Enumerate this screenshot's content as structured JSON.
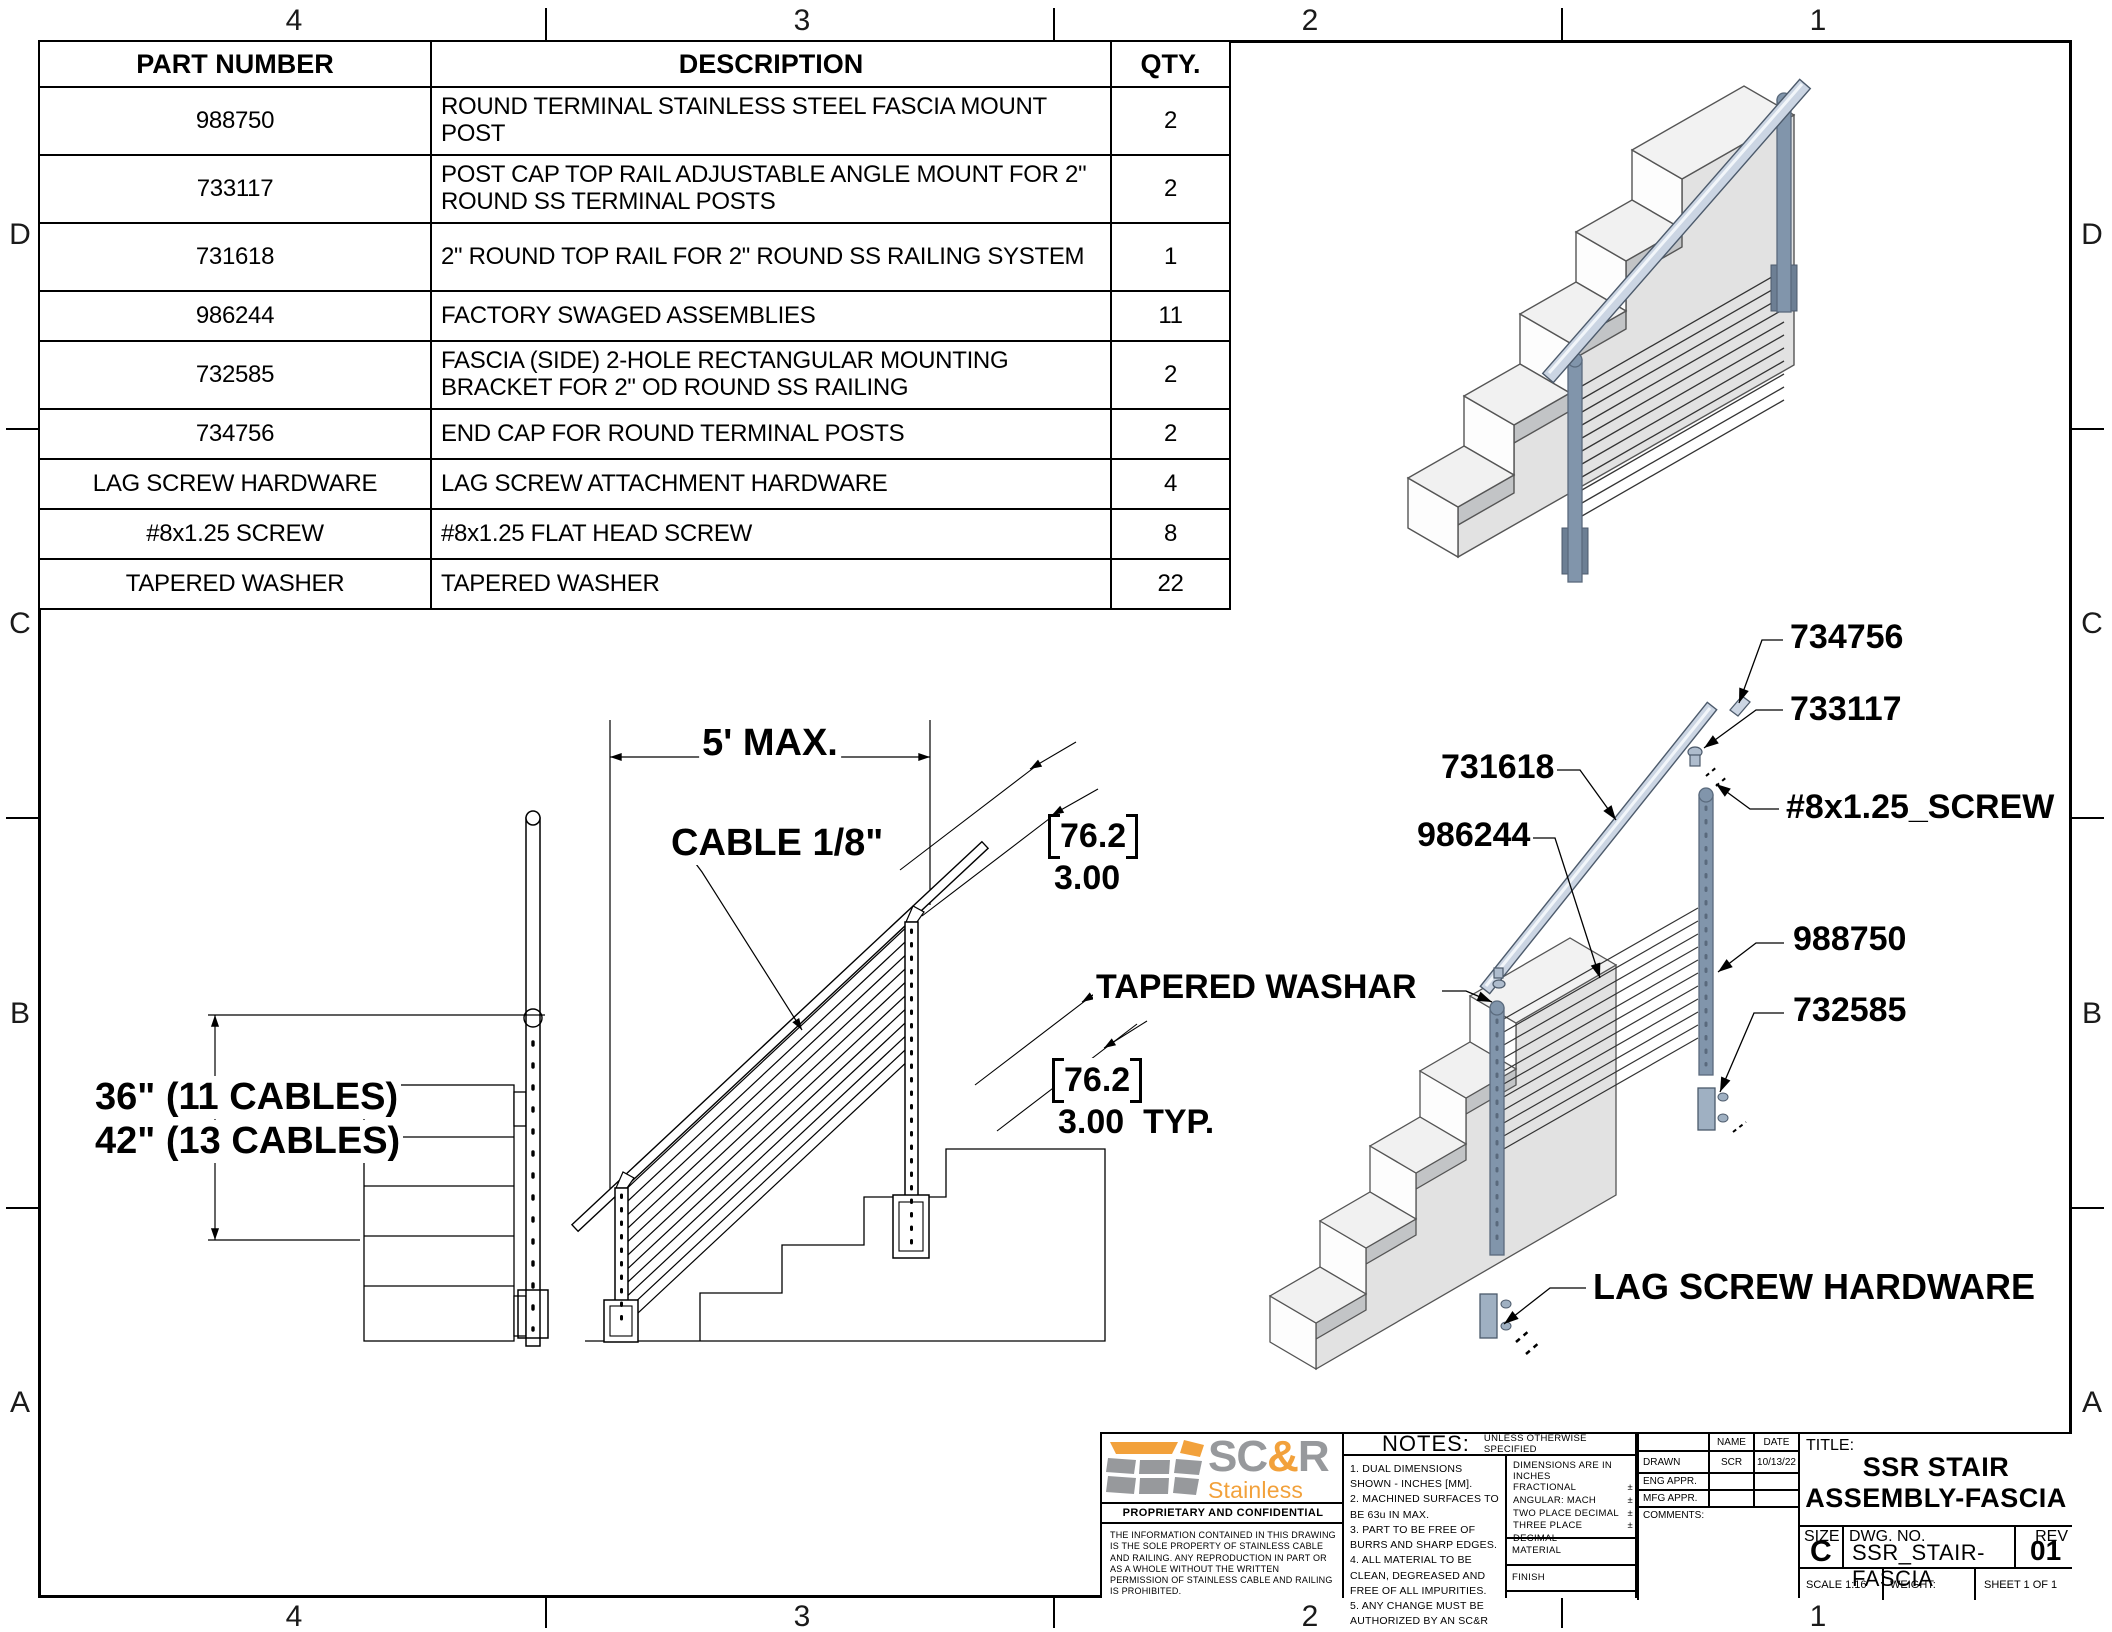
{
  "frame": {
    "top_numbers": [
      "4",
      "3",
      "2",
      "1"
    ],
    "bottom_numbers": [
      "4",
      "3",
      "2",
      "1"
    ],
    "left_letters": [
      "D",
      "C",
      "B",
      "A"
    ],
    "right_letters": [
      "D",
      "C",
      "B",
      "A"
    ]
  },
  "parts_table": {
    "headers": [
      "PART NUMBER",
      "DESCRIPTION",
      "QTY."
    ],
    "rows": [
      {
        "part": "988750",
        "desc": "ROUND TERMINAL STAINLESS STEEL FASCIA MOUNT POST",
        "qty": "2"
      },
      {
        "part": "733117",
        "desc": "POST CAP TOP RAIL ADJUSTABLE ANGLE MOUNT FOR 2\" ROUND SS TERMINAL POSTS",
        "qty": "2"
      },
      {
        "part": "731618",
        "desc": "2\" ROUND TOP RAIL FOR 2\" ROUND SS RAILING SYSTEM",
        "qty": "1"
      },
      {
        "part": "986244",
        "desc": "FACTORY SWAGED ASSEMBLIES",
        "qty": "11"
      },
      {
        "part": "732585",
        "desc": "FASCIA (SIDE) 2-HOLE RECTANGULAR MOUNTING BRACKET FOR 2\" OD ROUND SS RAILING",
        "qty": "2"
      },
      {
        "part": "734756",
        "desc": "END CAP FOR ROUND TERMINAL POSTS",
        "qty": "2"
      },
      {
        "part": "LAG SCREW HARDWARE",
        "desc": "LAG SCREW ATTACHMENT HARDWARE",
        "qty": "4"
      },
      {
        "part": "#8x1.25 SCREW",
        "desc": "#8x1.25 FLAT HEAD SCREW",
        "qty": "8"
      },
      {
        "part": "TAPERED WASHER",
        "desc": "TAPERED WASHER",
        "qty": "22"
      }
    ]
  },
  "front_view": {
    "dim_line1": "36\" (11 CABLES)",
    "dim_line2": "42\" (13 CABLES)"
  },
  "elevation": {
    "span_dim": "5' MAX.",
    "cable_label": "CABLE 1/8\"",
    "dim_a_mm": "76.2",
    "dim_a_in": "3.00",
    "dim_b_mm": "76.2",
    "dim_b_in": "3.00  TYP."
  },
  "exploded": {
    "callout_end_cap": "734756",
    "callout_post_cap": "733117",
    "callout_screw": "#8x1.25_SCREW",
    "callout_top_rail": "731618",
    "callout_cable_assembly": "986244",
    "callout_post": "988750",
    "callout_bracket": "732585",
    "callout_washer": "TAPERED WASHAR",
    "callout_lag": "LAG SCREW HARDWARE"
  },
  "title_block": {
    "logo": {
      "brand_sc": "SC",
      "brand_amp": "&",
      "brand_r": "R",
      "sub1": "Stainless Cable",
      "sub2": "& Railing",
      "proprietary": "PROPRIETARY AND CONFIDENTIAL",
      "legal": "THE INFORMATION CONTAINED IN THIS DRAWING IS THE SOLE PROPERTY OF STAINLESS CABLE AND RAILING. ANY REPRODUCTION IN PART OR AS A WHOLE WITHOUT THE WRITTEN PERMISSION OF STAINLESS CABLE AND RAILING IS PROHIBITED."
    },
    "notes": {
      "heading": "NOTES:",
      "qualifier": "UNLESS OTHERWISE SPECIFIED",
      "items": [
        "1. DUAL DIMENSIONS SHOWN - INCHES [MM].",
        "2. MACHINED SURFACES TO BE 63u IN MAX.",
        "3. PART TO BE FREE OF BURRS AND SHARP EDGES.",
        "4. ALL MATERIAL TO BE CLEAN, DEGREASED AND FREE OF ALL IMPURITIES.",
        "5. ANY CHANGE MUST BE AUTHORIZED BY AN SC&R ENGINEER."
      ]
    },
    "tolerances": {
      "heading": "DIMENSIONS ARE IN INCHES",
      "rows": [
        {
          "label": "FRACTIONAL",
          "pm": "±"
        },
        {
          "label": "ANGULAR: MACH",
          "pm": "±"
        },
        {
          "label": "TWO PLACE DECIMAL",
          "pm": "±"
        },
        {
          "label": "THREE PLACE DECIMAL",
          "pm": "±"
        }
      ],
      "material_label": "MATERIAL",
      "finish_label": "FINISH"
    },
    "approvals": {
      "name_header": "NAME",
      "date_header": "DATE",
      "rows": [
        {
          "label": "DRAWN",
          "name": "SCR",
          "date": "10/13/22"
        },
        {
          "label": "ENG APPR.",
          "name": "",
          "date": ""
        },
        {
          "label": "MFG APPR.",
          "name": "",
          "date": ""
        },
        {
          "label": "COMMENTS:",
          "name": "",
          "date": ""
        }
      ]
    },
    "title": {
      "label": "TITLE:",
      "line1": "SSR STAIR",
      "line2": "ASSEMBLY-FASCIA"
    },
    "doc": {
      "size_label": "SIZE",
      "size": "C",
      "dwg_label": "DWG.  NO.",
      "dwg_no": "SSR_STAIR-FASCIA",
      "rev_label": "REV",
      "rev": "01",
      "scale": "SCALE 1:16",
      "weight": "WEIGHT:",
      "sheet": "SHEET 1 OF 1"
    }
  },
  "colors": {
    "orange": "#F2A13B",
    "gray": "#97999C",
    "steel": "#8195AB",
    "steel_light": "#CBD5E3"
  }
}
